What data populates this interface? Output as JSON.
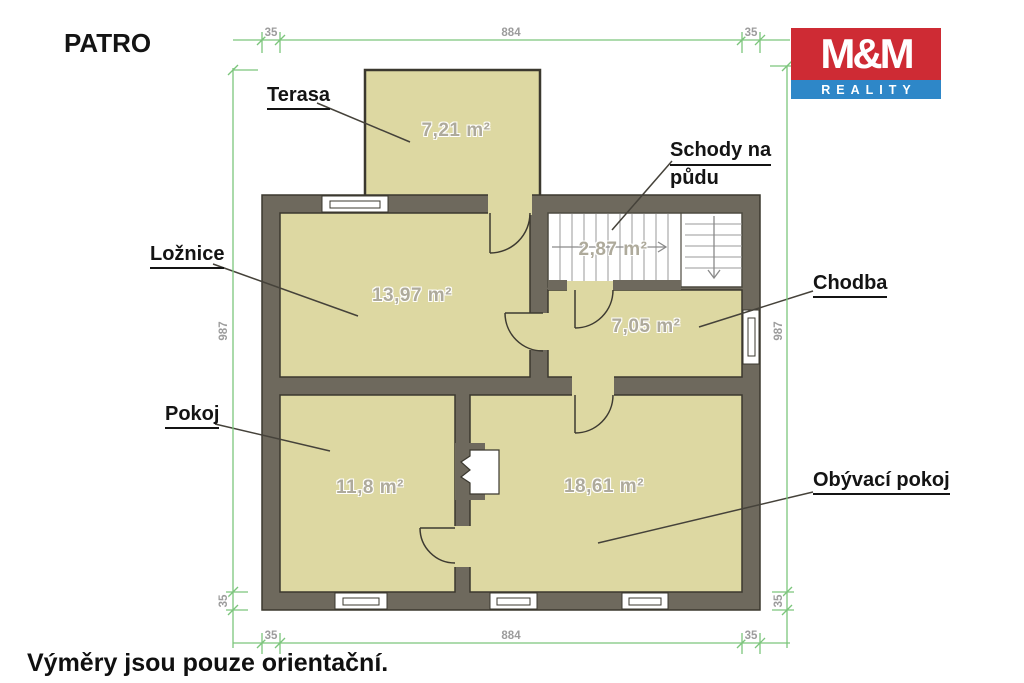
{
  "title": "PATRO",
  "note": "Výměry jsou pouze orientační.",
  "logo": {
    "line1": "M&M",
    "line2": "REALITY"
  },
  "rooms": {
    "terasa": {
      "name": "Terasa",
      "area": "7,21 m²"
    },
    "loznice": {
      "name": "Ložnice",
      "area": "13,97 m²"
    },
    "schody": {
      "name_line1": "Schody na",
      "name_line2": "půdu",
      "area": "2,87 m²"
    },
    "chodba": {
      "name": "Chodba",
      "area": "7,05 m²"
    },
    "pokoj": {
      "name": "Pokoj",
      "area": "11,8 m²"
    },
    "obyvaci": {
      "name": "Obývací pokoj",
      "area": "18,61 m²"
    }
  },
  "dimensions": {
    "top": {
      "left": "35",
      "middle": "884",
      "right": "35"
    },
    "bottom": {
      "left": "35",
      "middle": "884",
      "right": "35"
    },
    "left": {
      "main": "987",
      "wall": "35"
    },
    "right": {
      "main": "987",
      "wall": "35"
    }
  },
  "colors": {
    "wall": "#6e695d",
    "floor": "#ddd8a2",
    "dimension_green": "#7cc57c",
    "logo_red": "#ce2b34",
    "logo_blue": "#2e87c8"
  }
}
